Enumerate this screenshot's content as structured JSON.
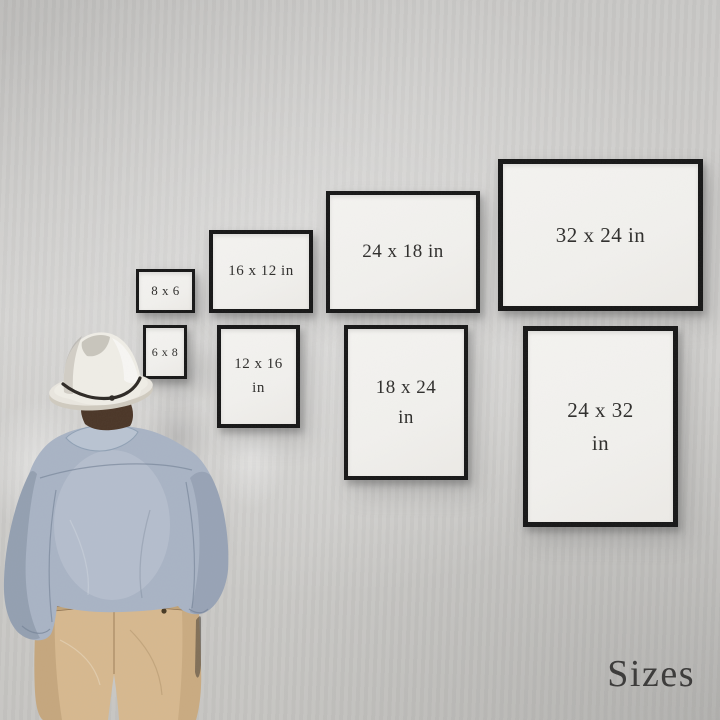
{
  "scene": {
    "caption": "Sizes"
  },
  "frames": [
    {
      "id": "8x6",
      "label": "8 x 6",
      "orientation": "landscape"
    },
    {
      "id": "16x12",
      "label": "16 x 12 in",
      "orientation": "landscape"
    },
    {
      "id": "24x18",
      "label": "24 x 18 in",
      "orientation": "landscape"
    },
    {
      "id": "32x24",
      "label": "32 x 24 in",
      "orientation": "landscape"
    },
    {
      "id": "6x8",
      "label": "6 x 8",
      "orientation": "portrait"
    },
    {
      "id": "12x16",
      "label": "12 x 16\nin",
      "orientation": "portrait"
    },
    {
      "id": "18x24",
      "label": "18 x 24\nin",
      "orientation": "portrait"
    },
    {
      "id": "24x32",
      "label": "24 x 32\nin",
      "orientation": "portrait"
    }
  ],
  "colors": {
    "wall": "#cbcac7",
    "frame_border": "#161616",
    "frame_mat": "#f2f1ee",
    "label_text": "#2e2d2b",
    "caption_text": "#3a3938",
    "hat": "#efede6",
    "hat_band": "#2c2824",
    "shirt": "#a8b3c4",
    "trousers": "#d6b88e",
    "hair": "#4a3526"
  }
}
